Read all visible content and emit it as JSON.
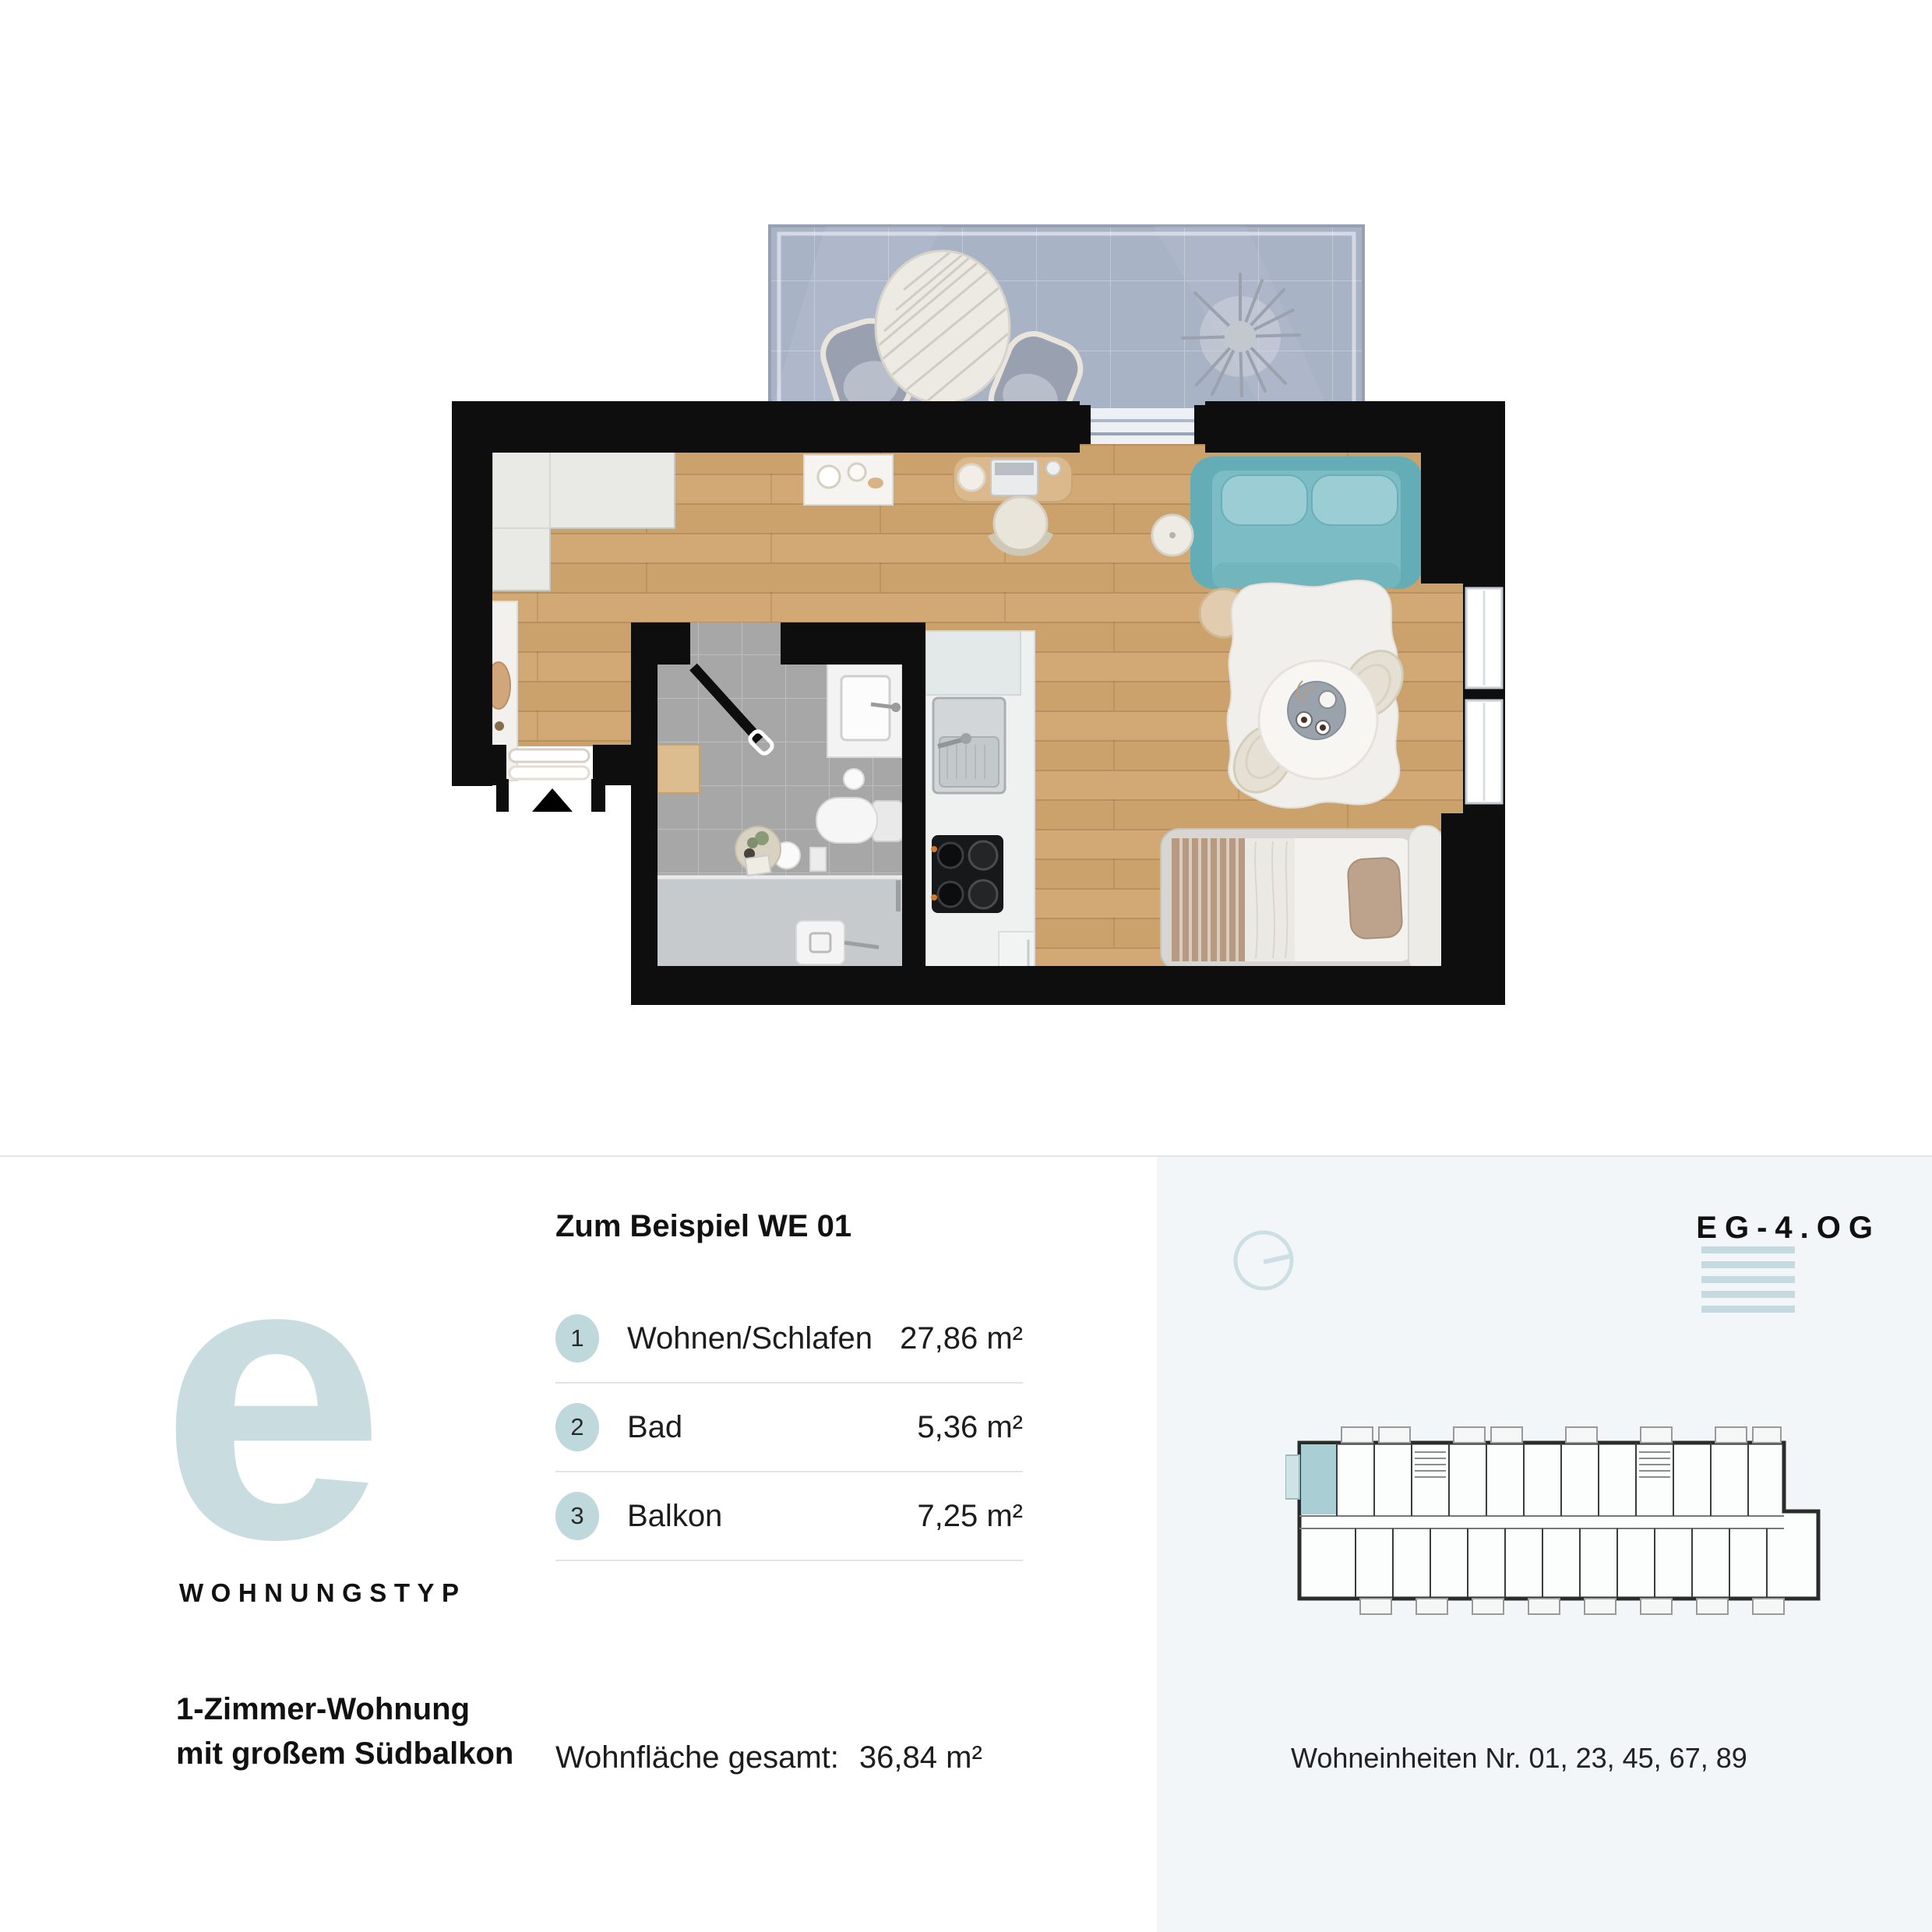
{
  "type_panel": {
    "letter": "e",
    "label": "WOHNUNGSTYP",
    "description_line1": "1-Zimmer-Wohnung",
    "description_line2": "mit großem Südbalkon"
  },
  "rooms_panel": {
    "heading": "Zum Beispiel WE 01",
    "rows": [
      {
        "num": "1",
        "label": "Wohnen/Schlafen",
        "area": "27,86 m²"
      },
      {
        "num": "2",
        "label": "Bad",
        "area": "5,36 m²"
      },
      {
        "num": "3",
        "label": "Balkon",
        "area": "7,25 m²"
      }
    ],
    "total_label": "Wohnfläche gesamt:",
    "total_value": "36,84 m²"
  },
  "location_panel": {
    "floors_label": "EG-4.OG",
    "units_label": "Wohneinheiten Nr. 01, 23, 45, 67, 89"
  },
  "icons": {
    "compass": "compass-icon",
    "floor_stack": "floor-stack-icon",
    "entry_arrow": "entry-arrow-icon"
  },
  "colors": {
    "accent_light": "#c9dde1",
    "badge": "#bed8dc",
    "floor_bars": "#c5dade",
    "unit_highlight": "#a9cfd4",
    "sofa_teal": "#65adb6",
    "wood_floor": "#cfa772",
    "balcony_floor": "#a9b3c6",
    "bath_tile": "#a7a7a7",
    "wall": "#0e0e0e",
    "panel_bg": "#f3f6f8"
  }
}
